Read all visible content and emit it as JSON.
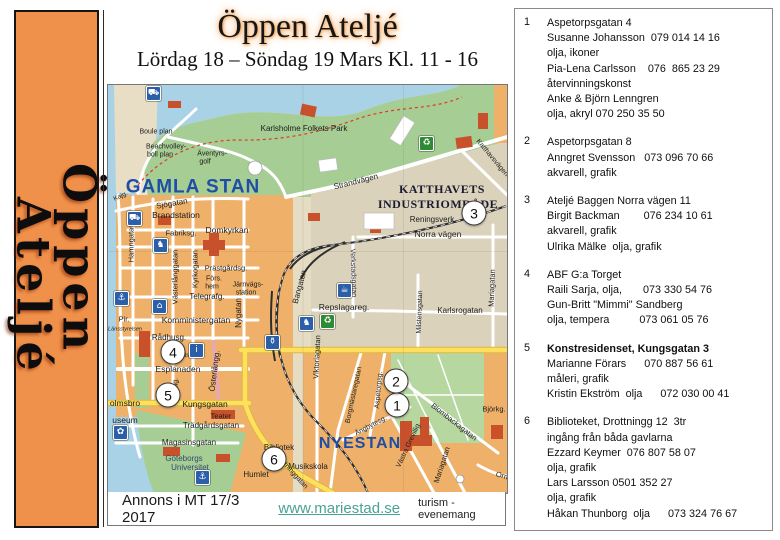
{
  "sidebar": {
    "word1": "Öppen",
    "word2": "Ateljé"
  },
  "header": {
    "title": "Öppen Ateljé",
    "subtitle": "Lördag 18 – Söndag 19 Mars  Kl. 11 - 16"
  },
  "footer": {
    "annons": "Annons i MT 17/3 2017",
    "link": "www.mariestad.se",
    "tagline": "turism - evenemang"
  },
  "map": {
    "labels": [
      {
        "id": "gamla-stan",
        "text": "GAMLA STAN",
        "x": 85,
        "y": 102,
        "size": 19,
        "bold": true,
        "color": "#1E4FA5",
        "spacing": 1
      },
      {
        "id": "nyestan",
        "text": "NYESTAN",
        "x": 252,
        "y": 359,
        "size": 16,
        "bold": true,
        "color": "#1E4FA5",
        "spacing": 1
      },
      {
        "id": "katthavets",
        "text": "KATTHAVETS",
        "x": 334,
        "y": 104,
        "size": 12,
        "bold": true,
        "serif": true,
        "color": "#1b1b30",
        "spacing": 0.5
      },
      {
        "id": "industriomrade",
        "text": "INDUSTRIOMRÅDE",
        "x": 330,
        "y": 119,
        "size": 12,
        "bold": true,
        "serif": true,
        "color": "#1b1b30",
        "spacing": 0.5
      },
      {
        "id": "boule-plan",
        "text": "Boule plan",
        "x": 48,
        "y": 47
      },
      {
        "id": "beachvolley",
        "text": "Beachvolley-",
        "x": 58,
        "y": 62
      },
      {
        "id": "bollplan",
        "text": "boll plan",
        "x": 52,
        "y": 70
      },
      {
        "id": "aventyrs",
        "text": "Äventyrs-",
        "x": 104,
        "y": 69
      },
      {
        "id": "golf",
        "text": "golf",
        "x": 97,
        "y": 77
      },
      {
        "id": "karlsholme",
        "text": "Karlsholme Folkets Park",
        "x": 196,
        "y": 44,
        "size": 8
      },
      {
        "id": "strandvagen",
        "text": "Strandvägen",
        "x": 248,
        "y": 97,
        "size": 8,
        "rot": -14
      },
      {
        "id": "katthavsvagen",
        "text": "Katthavsvägen",
        "x": 384,
        "y": 73,
        "rot": 50
      },
      {
        "id": "kajg",
        "text": "Kajg.",
        "x": 13,
        "y": 112,
        "size": 6.5,
        "rot": -25
      },
      {
        "id": "sjogatan",
        "text": "Sjögatan",
        "x": 64,
        "y": 119,
        "size": 8,
        "rot": -10
      },
      {
        "id": "brandstation",
        "text": "Brandstation",
        "x": 68,
        "y": 130,
        "size": 8.5
      },
      {
        "id": "fabriksg",
        "text": "Fabriksg.",
        "x": 73,
        "y": 148,
        "size": 7.5
      },
      {
        "id": "domkyrkan",
        "text": "Domkyrkan",
        "x": 119,
        "y": 145,
        "size": 8.5
      },
      {
        "id": "hamngatan",
        "text": "Hamngatan",
        "x": 23,
        "y": 158,
        "size": 7.5,
        "rot": -90
      },
      {
        "id": "vasterlanggatan",
        "text": "Västerlånggatan",
        "x": 67,
        "y": 192,
        "size": 7.5,
        "rot": -90
      },
      {
        "id": "kyrkogatan",
        "text": "Kyrkogatan",
        "x": 87,
        "y": 184,
        "size": 7.5,
        "rot": -90
      },
      {
        "id": "prastgardsg",
        "text": "Prästgårdsg.",
        "x": 118,
        "y": 183,
        "size": 7.5
      },
      {
        "id": "fors",
        "text": "Förs.",
        "x": 106,
        "y": 194
      },
      {
        "id": "hem",
        "text": "hem",
        "x": 104,
        "y": 202
      },
      {
        "id": "jarnvags",
        "text": "Järnvägs-",
        "x": 140,
        "y": 200
      },
      {
        "id": "station",
        "text": "station",
        "x": 138,
        "y": 208
      },
      {
        "id": "telegrafg",
        "text": "Telegrafg.",
        "x": 99,
        "y": 212,
        "size": 8
      },
      {
        "id": "nygatan",
        "text": "Nygatan",
        "x": 131,
        "y": 228,
        "size": 8,
        "rot": -90
      },
      {
        "id": "komministergatan",
        "text": "Komministergatan",
        "x": 88,
        "y": 235,
        "size": 8.5
      },
      {
        "id": "radhusg",
        "text": "Rådhusg.",
        "x": 61,
        "y": 253,
        "size": 8
      },
      {
        "id": "stadshus",
        "text": "stadshus",
        "x": 79,
        "y": 271,
        "size": 6.5
      },
      {
        "id": "esplanaden",
        "text": "Esplanaden",
        "x": 70,
        "y": 284,
        "size": 8.5
      },
      {
        "id": "karlag",
        "text": "Karlag.",
        "x": 68,
        "y": 304,
        "rot": -90
      },
      {
        "id": "osterlangg",
        "text": "Österlångg.",
        "x": 107,
        "y": 286,
        "size": 8,
        "rot": -83
      },
      {
        "id": "holmsbro",
        "text": "olmsbro",
        "x": 17,
        "y": 318,
        "size": 8.5
      },
      {
        "id": "kungsgatan",
        "text": "Kungsgatan",
        "x": 97,
        "y": 319,
        "size": 8.5
      },
      {
        "id": "museum",
        "text": "useum",
        "x": 17,
        "y": 335,
        "size": 8.5
      },
      {
        "id": "teater",
        "text": "Teater",
        "x": 113,
        "y": 331,
        "size": 7.5
      },
      {
        "id": "tradgardsgatan",
        "text": "Trädgårdsgatan",
        "x": 103,
        "y": 341,
        "size": 8
      },
      {
        "id": "magasinsgatan",
        "text": "Magasinsgatan",
        "x": 81,
        "y": 358,
        "size": 8
      },
      {
        "id": "goteborgs",
        "text": "Göteborgs",
        "x": 76,
        "y": 374,
        "size": 8,
        "color": "#2F4A6E"
      },
      {
        "id": "universitet",
        "text": "Universitet",
        "x": 82,
        "y": 383,
        "size": 8,
        "color": "#2F4A6E"
      },
      {
        "id": "bibliotek",
        "text": "Bibliotek",
        "x": 171,
        "y": 363,
        "size": 8
      },
      {
        "id": "drottninggatan",
        "text": "Drottninggatan",
        "x": 183,
        "y": 386,
        "rot": 48
      },
      {
        "id": "humlet",
        "text": "Humlet",
        "x": 148,
        "y": 390,
        "size": 8
      },
      {
        "id": "musikskola",
        "text": "Musikskola",
        "x": 200,
        "y": 382,
        "size": 8
      },
      {
        "id": "viktoriagatan",
        "text": "Viktoriagatan",
        "x": 209,
        "y": 272,
        "size": 7.5,
        "rot": -87
      },
      {
        "id": "borgmastaregatan",
        "text": "Borgmästaregatan",
        "x": 246,
        "y": 310,
        "rot": -78
      },
      {
        "id": "aspetorpsg",
        "text": "Aspetorpsg.",
        "x": 271,
        "y": 305,
        "rot": -85
      },
      {
        "id": "angbytesg",
        "text": "Ängbytesg.",
        "x": 263,
        "y": 341,
        "rot": -28
      },
      {
        "id": "vastra-grevillig",
        "text": "Västra Grevillig.",
        "x": 301,
        "y": 360,
        "rot": -65
      },
      {
        "id": "blombackagatan",
        "text": "Blombackagatan",
        "x": 346,
        "y": 337,
        "size": 7.5,
        "rot": 38
      },
      {
        "id": "mariagatan-s",
        "text": "Mariagatan",
        "x": 334,
        "y": 380,
        "size": 7.5,
        "rot": -72
      },
      {
        "id": "bjorkg",
        "text": "Björkg.",
        "x": 386,
        "y": 324,
        "size": 7.5
      },
      {
        "id": "orm",
        "text": "Orm",
        "x": 395,
        "y": 391,
        "size": 7.5,
        "rot": 15
      },
      {
        "id": "karlsrogatan",
        "text": "Karlsrogatan",
        "x": 352,
        "y": 226,
        "size": 8
      },
      {
        "id": "mariagatan-n",
        "text": "Mariagatan",
        "x": 384,
        "y": 203,
        "size": 7.5,
        "rot": -88
      },
      {
        "id": "milstensgatan",
        "text": "Milstensgatan",
        "x": 312,
        "y": 227,
        "rot": -88
      },
      {
        "id": "norra-vagen",
        "text": "Norra vägen",
        "x": 330,
        "y": 149,
        "size": 8.5
      },
      {
        "id": "reningsverk",
        "text": "Reningsverk",
        "x": 324,
        "y": 135,
        "size": 8
      },
      {
        "id": "bangatan",
        "text": "Bangatan",
        "x": 192,
        "y": 202,
        "size": 8,
        "rot": -75
      },
      {
        "id": "verkstadsgatan",
        "text": "Verkstadsgatan",
        "x": 245,
        "y": 188,
        "rot": 88
      },
      {
        "id": "repslagareg",
        "text": "Repslagareg.",
        "x": 236,
        "y": 222,
        "size": 8.5
      },
      {
        "id": "pir",
        "text": "Pir.",
        "x": 16,
        "y": 234,
        "size": 7.5
      },
      {
        "id": "lansstyrelsen",
        "text": "Länsstyrelsen",
        "x": 17,
        "y": 245,
        "size": 5.5,
        "italic": true
      }
    ],
    "markers": [
      {
        "n": "1",
        "x": 289,
        "y": 320
      },
      {
        "n": "2",
        "x": 288,
        "y": 296
      },
      {
        "n": "3",
        "x": 366,
        "y": 128
      },
      {
        "n": "4",
        "x": 65,
        "y": 267
      },
      {
        "n": "5",
        "x": 60,
        "y": 310
      },
      {
        "n": "6",
        "x": 166,
        "y": 374
      }
    ],
    "icons": [
      {
        "name": "camper-icon",
        "glyph": "⛟",
        "x": 38,
        "y": 1,
        "color": "blue"
      },
      {
        "name": "firestation-icon",
        "glyph": "⛟",
        "x": 19,
        "y": 126,
        "color": "blue"
      },
      {
        "name": "moose-icon",
        "glyph": "♞",
        "x": 45,
        "y": 153,
        "color": "blue"
      },
      {
        "name": "anchor-icon",
        "glyph": "⚓",
        "x": 6,
        "y": 206,
        "color": "blue"
      },
      {
        "name": "church-icon",
        "glyph": "⌂",
        "x": 44,
        "y": 214,
        "color": "blue"
      },
      {
        "name": "info-icon",
        "glyph": "i",
        "x": 81,
        "y": 258,
        "color": "blue"
      },
      {
        "name": "museum-flower-icon",
        "glyph": "✿",
        "x": 5,
        "y": 340,
        "color": "blue"
      },
      {
        "name": "harbor-anchor-icon",
        "glyph": "⚓",
        "x": 87,
        "y": 385,
        "color": "blue"
      },
      {
        "name": "cafe-icon",
        "glyph": "☕",
        "x": 229,
        "y": 198,
        "color": "blue"
      },
      {
        "name": "moose2-icon",
        "glyph": "♞",
        "x": 191,
        "y": 231,
        "color": "blue"
      },
      {
        "name": "bottle-icon",
        "glyph": "⚱",
        "x": 157,
        "y": 250,
        "color": "blue"
      },
      {
        "name": "recycle-icon-1",
        "glyph": "♻",
        "x": 212,
        "y": 229,
        "color": "green"
      },
      {
        "name": "recycle-icon-2",
        "glyph": "♻",
        "x": 311,
        "y": 51,
        "color": "green"
      }
    ],
    "colors": {
      "water": "#A9D2E6",
      "park": "#A6CD94",
      "blocks": "#EFB169",
      "industrial": "#DBD2BC",
      "main_road": "#FFDF5C",
      "banner": "#F0914B"
    }
  },
  "listings": [
    {
      "num": "1",
      "lines": [
        "Aspetorpsgatan 4",
        "Susanne Johansson  079 014 14 16",
        "olja, ikoner",
        "Pia-Lena Carlsson    076  865 23 29",
        "återvinningskonst",
        "Anke & Björn Lenngren",
        "olja, akryl 070 250 35 50"
      ]
    },
    {
      "num": "2",
      "lines": [
        "Aspetorpsgatan 8",
        "Anngret Svensson   073 096 70 66",
        "akvarell, grafik"
      ]
    },
    {
      "num": "3",
      "lines": [
        "Ateljé Baggen Norra vägen 11",
        "Birgit Backman        076 234 10 61",
        "akvarell, grafik",
        "Ulrika Mälke  olja, grafik"
      ]
    },
    {
      "num": "4",
      "lines": [
        "ABF G:a Torget",
        "Raili Sarja, olja,       073 330 54 76",
        "Gun-Britt \"Mimmi\" Sandberg",
        "olja, tempera          073 061 05 76"
      ]
    },
    {
      "num": "5",
      "lines": [
        "Konstresidenset, Kungsgatan 3",
        "Marianne Förars      070 887 56 61",
        "måleri, grafik",
        "Kristin Ekström  olja      072 030 00 41"
      ]
    },
    {
      "num": "6",
      "lines": [
        "Biblioteket, Drottningg 12  3tr",
        "ingång från båda gavlarna",
        "Ezzard Keymer  076 807 58 07",
        "olja, grafik",
        "Lars Larsson 0501 352 27",
        "olja, grafik",
        "Håkan Thunborg  olja      073 324 76 67"
      ]
    }
  ]
}
